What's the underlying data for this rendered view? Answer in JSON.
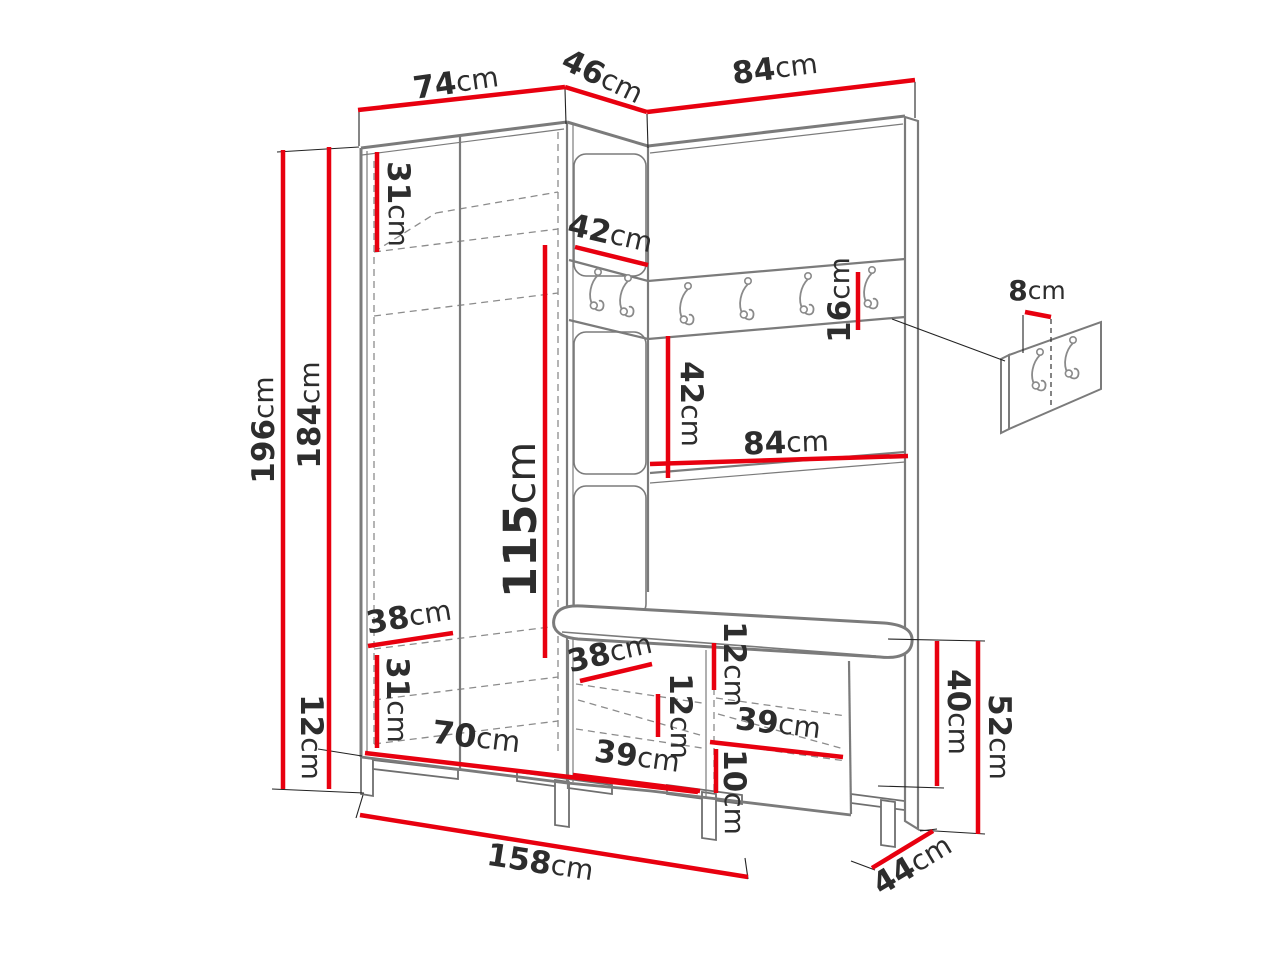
{
  "diagram": {
    "type": "furniture-dimension-diagram",
    "subject": "corner hallway wardrobe set with coat hooks, shelves and shoe bench",
    "unit_default": "cm"
  },
  "colors": {
    "dimension_line": "#e8000f",
    "label_text": "#2d2d2d",
    "furniture_outline": "#7b7b7b",
    "background": "#ffffff"
  },
  "icons": [
    {
      "name": "coat-hook-icon",
      "count": 8
    }
  ],
  "dimensions": [
    {
      "id": "top-width-left",
      "value": "74",
      "unit": "cm",
      "line": [
        358,
        110,
        565,
        87
      ],
      "label": [
        456,
        84,
        -8,
        31
      ]
    },
    {
      "id": "top-width-corner",
      "value": "46",
      "unit": "cm",
      "line": [
        565,
        87,
        647,
        112
      ],
      "label": [
        602,
        78,
        26,
        31
      ]
    },
    {
      "id": "top-width-right",
      "value": "84",
      "unit": "cm",
      "line": [
        647,
        112,
        915,
        80
      ],
      "label": [
        775,
        70,
        -7,
        31
      ]
    },
    {
      "id": "total-height",
      "value": "196",
      "unit": "cm",
      "line": [
        283,
        150,
        283,
        789
      ],
      "label": [
        265,
        430,
        -90,
        31
      ]
    },
    {
      "id": "body-height",
      "value": "184",
      "unit": "cm",
      "line": [
        329,
        147,
        329,
        748
      ],
      "label": [
        311,
        415,
        -90,
        31
      ]
    },
    {
      "id": "leg-height",
      "value": "12",
      "unit": "cm",
      "line": [
        329,
        748,
        329,
        789
      ],
      "label": [
        310,
        737,
        90,
        31
      ]
    },
    {
      "id": "top-shelf-height",
      "value": "31",
      "unit": "cm",
      "line": [
        377,
        152,
        377,
        252
      ],
      "label": [
        397,
        204,
        90,
        31
      ]
    },
    {
      "id": "corner-shelf-width",
      "value": "42",
      "unit": "cm",
      "line": [
        575,
        247,
        648,
        265
      ],
      "label": [
        610,
        235,
        13,
        31
      ]
    },
    {
      "id": "hook-rail-height",
      "value": "16",
      "unit": "cm",
      "line": [
        858,
        272,
        858,
        330
      ],
      "label": [
        841,
        300,
        -90,
        31
      ]
    },
    {
      "id": "wall-hook-spacing",
      "value": "8",
      "unit": "cm",
      "line": [
        1025,
        312,
        1051,
        317
      ],
      "label": [
        1037,
        292,
        0,
        28
      ]
    },
    {
      "id": "hanging-space-height",
      "value": "115",
      "unit": "cm",
      "line": [
        545,
        245,
        545,
        658
      ],
      "label": [
        524,
        520,
        -90,
        45
      ]
    },
    {
      "id": "back-panel-height",
      "value": "42",
      "unit": "cm",
      "line": [
        668,
        336,
        668,
        478
      ],
      "label": [
        690,
        404,
        90,
        31
      ]
    },
    {
      "id": "back-panel-width",
      "value": "84",
      "unit": "cm",
      "line": [
        650,
        464,
        908,
        456
      ],
      "label": [
        786,
        444,
        -2,
        31
      ]
    },
    {
      "id": "wardrobe-shelf-depth",
      "value": "38",
      "unit": "cm",
      "line": [
        368,
        646,
        453,
        633
      ],
      "label": [
        409,
        618,
        -9,
        31
      ]
    },
    {
      "id": "bottom-shelf-height",
      "value": "31",
      "unit": "cm",
      "line": [
        377,
        655,
        377,
        748
      ],
      "label": [
        396,
        700,
        90,
        31
      ]
    },
    {
      "id": "wardrobe-inner-width",
      "value": "70",
      "unit": "cm",
      "line": [
        365,
        753,
        698,
        792
      ],
      "label": [
        476,
        739,
        7,
        32
      ]
    },
    {
      "id": "bench-shelf-depth",
      "value": "38",
      "unit": "cm",
      "line": [
        580,
        681,
        652,
        664
      ],
      "label": [
        610,
        654,
        -13,
        31
      ]
    },
    {
      "id": "cushion-box-height",
      "value": "12",
      "unit": "cm",
      "line": [
        714,
        643,
        714,
        690
      ],
      "label": [
        733,
        664,
        90,
        31
      ]
    },
    {
      "id": "bench-shelf-height",
      "value": "12",
      "unit": "cm",
      "line": [
        658,
        694,
        658,
        737
      ],
      "label": [
        679,
        716,
        90,
        31
      ]
    },
    {
      "id": "bench-inner-width-upper",
      "value": "39",
      "unit": "cm",
      "line": [
        710,
        742,
        843,
        757
      ],
      "label": [
        778,
        725,
        7,
        31
      ]
    },
    {
      "id": "bench-lower-height",
      "value": "10",
      "unit": "cm",
      "line": [
        716,
        749,
        716,
        793
      ],
      "label": [
        733,
        792,
        90,
        31
      ]
    },
    {
      "id": "bench-inner-width-lower",
      "value": "39",
      "unit": "cm",
      "line": [
        573,
        775,
        700,
        791
      ],
      "label": [
        637,
        758,
        8,
        31
      ]
    },
    {
      "id": "bench-inner-height",
      "value": "40",
      "unit": "cm",
      "line": [
        937,
        641,
        937,
        786
      ],
      "label": [
        957,
        712,
        90,
        31
      ]
    },
    {
      "id": "bench-total-height",
      "value": "52",
      "unit": "cm",
      "line": [
        978,
        641,
        978,
        834
      ],
      "label": [
        998,
        737,
        90,
        31
      ]
    },
    {
      "id": "bench-depth",
      "value": "44",
      "unit": "cm",
      "line": [
        872,
        868,
        933,
        831
      ],
      "label": [
        913,
        866,
        -31,
        31
      ]
    },
    {
      "id": "total-width",
      "value": "158",
      "unit": "cm",
      "line": [
        360,
        815,
        748,
        877
      ],
      "label": [
        540,
        864,
        9,
        31
      ]
    }
  ]
}
